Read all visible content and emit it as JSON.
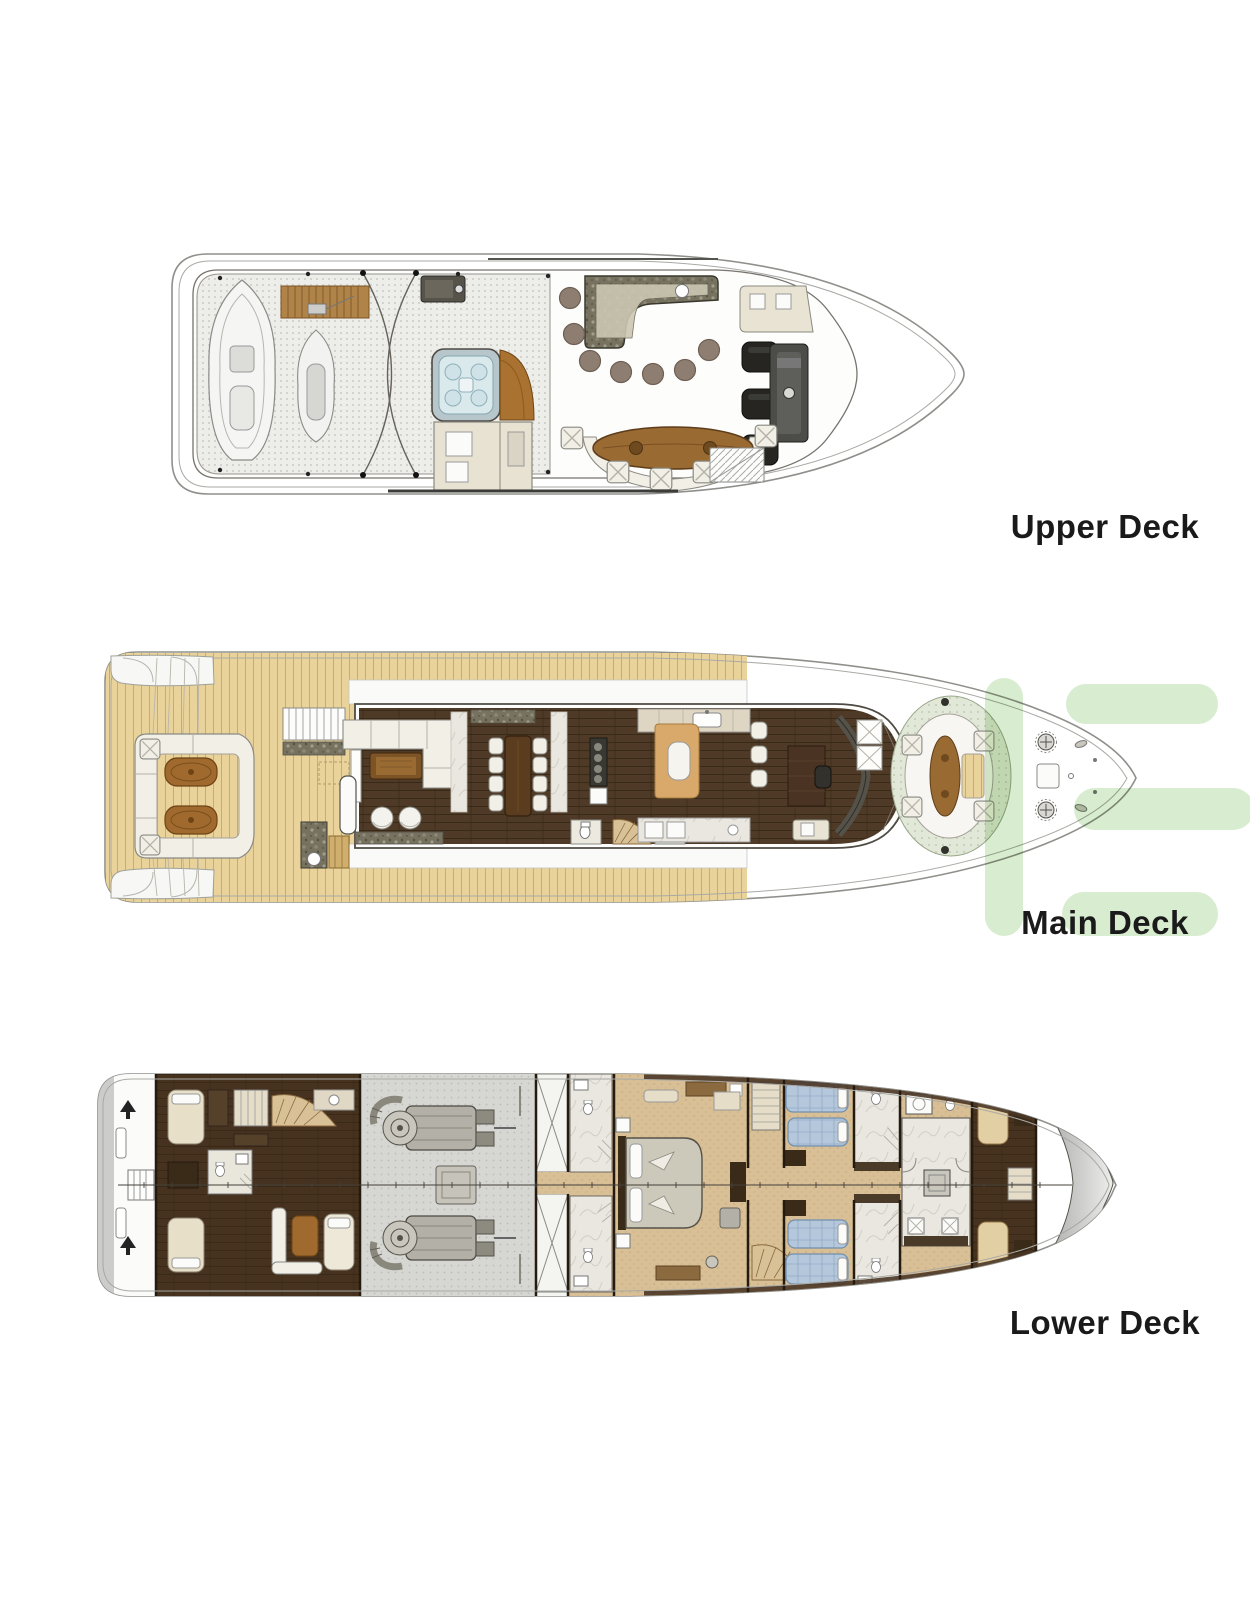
{
  "decks": [
    {
      "id": "upper-deck",
      "label": "Upper Deck"
    },
    {
      "id": "main-deck",
      "label": "Main Deck"
    },
    {
      "id": "lower-deck",
      "label": "Lower Deck"
    }
  ],
  "watermark": {
    "color": "#d8ecd0"
  },
  "palette": {
    "paper": "#ffffff",
    "hull_line": "#8f8f8b",
    "inner_line": "#a9a9a5",
    "deck_dots_base": "#ededea",
    "teak": "#e9d39a",
    "teak_line": "#c6a76c",
    "salon_plank": "#4e3a26",
    "crew_plank": "#46321f",
    "plank_line": "#392917",
    "wood_table": "#9a6a33",
    "wood_table_dark": "#6e4a1e",
    "granite": "#76725f",
    "marble": "#eae7e0",
    "beige_seat": "#e8e3d3",
    "white_seat": "#f2efe7",
    "jacuzzi_fill": "#d9e9ec",
    "jacuzzi_frame": "#b7c6ca",
    "black_chair": "#262522",
    "stool_brown": "#8d7e71",
    "guest_tan": "#d8bf95",
    "engine_gray": "#d6d6d2",
    "bed_blue": "#b5c7db",
    "booth_orange": "#d9a96c",
    "bow_gray": "#a2a2a0",
    "dark_wood": "#3a2a18",
    "label_text": "#1a1a1a"
  }
}
